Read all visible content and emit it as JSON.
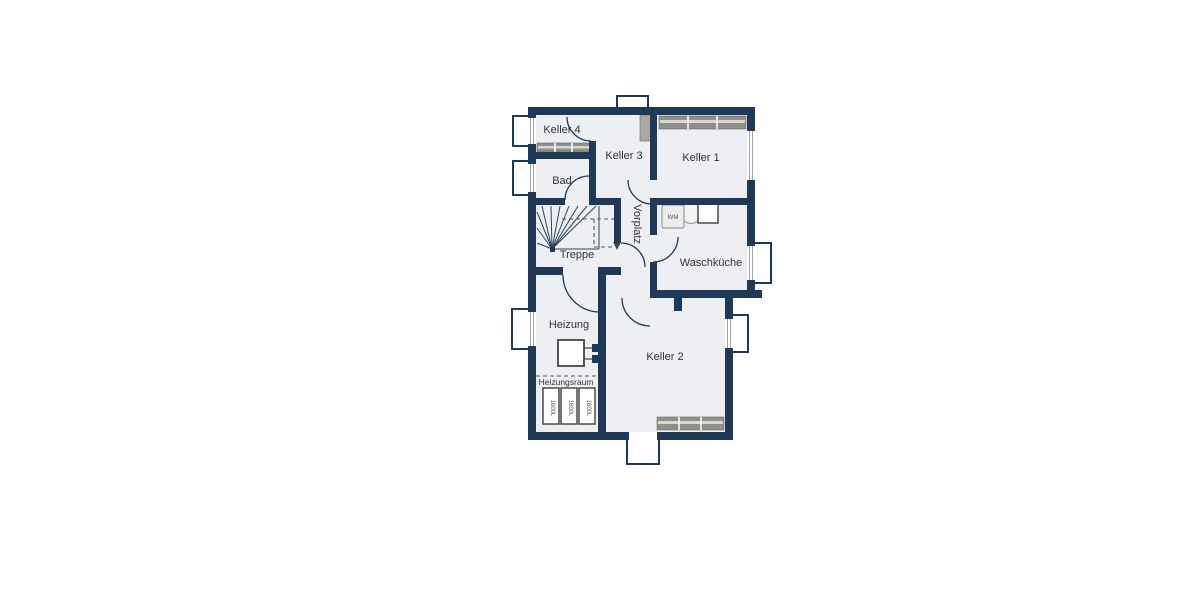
{
  "plan": {
    "type": "floor-plan",
    "floor": "basement",
    "colors": {
      "wall": "#1f3a58",
      "floor": "#edeff3",
      "background": "#ffffff",
      "radiator": "#90908a",
      "text": "#333333",
      "dashed_line": "#555555"
    },
    "rooms": [
      {
        "id": "keller4",
        "label": "Keller 4"
      },
      {
        "id": "bad",
        "label": "Bad"
      },
      {
        "id": "keller3",
        "label": "Keller 3"
      },
      {
        "id": "keller1",
        "label": "Keller 1"
      },
      {
        "id": "treppe",
        "label": "Treppe"
      },
      {
        "id": "vorplatz",
        "label": "Vorplatz"
      },
      {
        "id": "waschkueche",
        "label": "Waschküche"
      },
      {
        "id": "heizung",
        "label": "Heizung"
      },
      {
        "id": "keller2",
        "label": "Keller 2"
      }
    ],
    "zones": [
      {
        "id": "heizungsraum",
        "label": "Heizungsraum"
      }
    ],
    "fixtures": {
      "washing_machine": "WM",
      "tanks": [
        "1600L",
        "1600L",
        "1600L"
      ]
    }
  }
}
